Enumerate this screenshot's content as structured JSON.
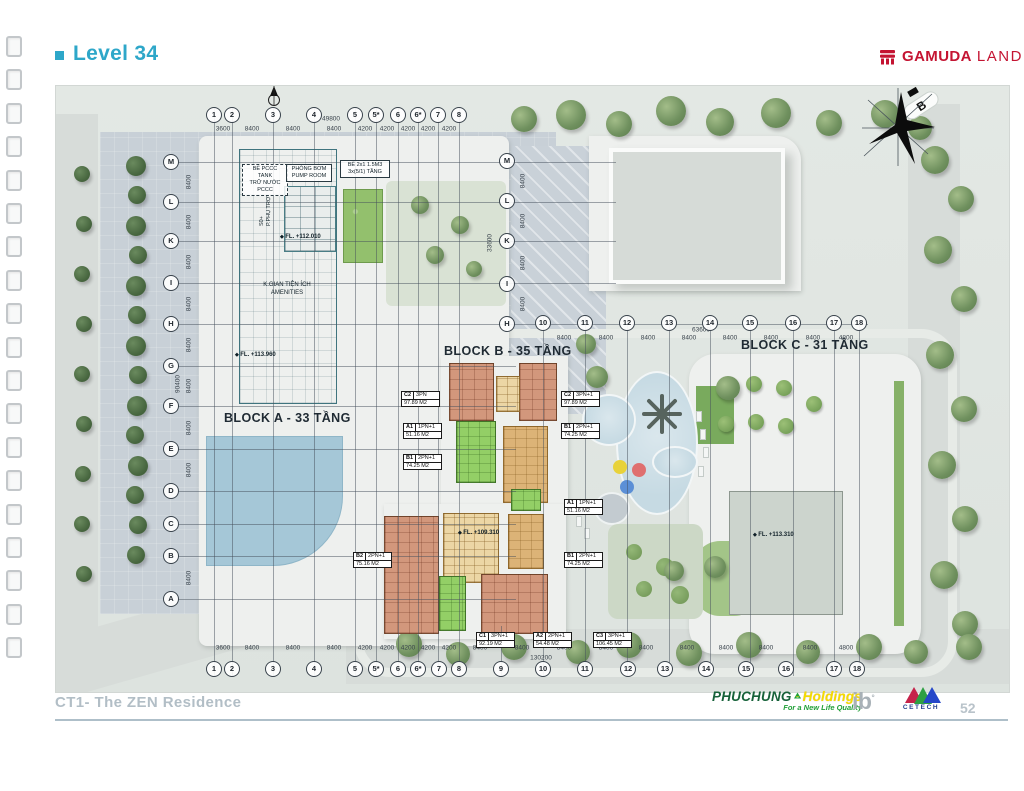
{
  "header": {
    "title": "Level 34",
    "brand": {
      "bold": "GAMUDA",
      "light": "LAND",
      "color": "#c41432"
    }
  },
  "plan": {
    "north_label": "B",
    "blocks": {
      "a": {
        "label": "BLOCK A - 33 TẦNG",
        "tank": "BỂ PCCC TANK\nTRỮ NƯỚC PCCC",
        "pump": "PHÒNG BƠM\nPUMP ROOM",
        "table": "BỂ 2x1 1.5M3\n3x(5/1) TẦNG",
        "aux": "S0+\nP.PHỤ TRỢ",
        "fl1": "FL. +112.010",
        "fl2": "FL. +113.960",
        "amenities": "K.GIAN TIỆN ÍCH\nAMENITIES"
      },
      "b": {
        "label": "BLOCK B - 35 TẦNG",
        "fl": "FL. +109.310"
      },
      "c": {
        "label": "BLOCK C - 31 TẦNG",
        "fl": "FL. +113.310"
      }
    },
    "grid": {
      "top": [
        {
          "label": "1",
          "x": 158
        },
        {
          "label": "2",
          "x": 176
        },
        {
          "label": "3",
          "x": 217
        },
        {
          "label": "4",
          "x": 258
        },
        {
          "label": "5",
          "x": 299
        },
        {
          "label": "5*",
          "x": 320
        },
        {
          "label": "6",
          "x": 342
        },
        {
          "label": "6*",
          "x": 362
        },
        {
          "label": "7",
          "x": 382
        },
        {
          "label": "8",
          "x": 403
        }
      ],
      "mid": [
        {
          "label": "10",
          "x": 487
        },
        {
          "label": "11",
          "x": 529
        },
        {
          "label": "12",
          "x": 571
        },
        {
          "label": "13",
          "x": 613
        },
        {
          "label": "14",
          "x": 654
        },
        {
          "label": "15",
          "x": 694
        },
        {
          "label": "16",
          "x": 737
        },
        {
          "label": "17",
          "x": 778
        },
        {
          "label": "18",
          "x": 803
        }
      ],
      "bottom": [
        {
          "label": "1",
          "x": 158
        },
        {
          "label": "2",
          "x": 176
        },
        {
          "label": "3",
          "x": 217
        },
        {
          "label": "4",
          "x": 258
        },
        {
          "label": "5",
          "x": 299
        },
        {
          "label": "5*",
          "x": 320
        },
        {
          "label": "6",
          "x": 342
        },
        {
          "label": "6*",
          "x": 362
        },
        {
          "label": "7",
          "x": 383
        },
        {
          "label": "8",
          "x": 403
        },
        {
          "label": "9",
          "x": 445
        },
        {
          "label": "10",
          "x": 487
        },
        {
          "label": "11",
          "x": 529
        },
        {
          "label": "12",
          "x": 572
        },
        {
          "label": "13",
          "x": 609
        },
        {
          "label": "14",
          "x": 650
        },
        {
          "label": "15",
          "x": 690
        },
        {
          "label": "16",
          "x": 730
        },
        {
          "label": "17",
          "x": 778
        },
        {
          "label": "18",
          "x": 801
        }
      ],
      "left_rows": [
        {
          "label": "M",
          "y": 76
        },
        {
          "label": "L",
          "y": 116
        },
        {
          "label": "K",
          "y": 155
        },
        {
          "label": "I",
          "y": 197
        },
        {
          "label": "H",
          "y": 238
        },
        {
          "label": "G",
          "y": 280
        },
        {
          "label": "F",
          "y": 320
        },
        {
          "label": "E",
          "y": 363
        },
        {
          "label": "D",
          "y": 405
        },
        {
          "label": "C",
          "y": 438
        },
        {
          "label": "B",
          "y": 470
        },
        {
          "label": "A",
          "y": 513
        }
      ],
      "mid_rows": [
        {
          "label": "M",
          "y": 75
        },
        {
          "label": "L",
          "y": 115
        },
        {
          "label": "K",
          "y": 155
        },
        {
          "label": "I",
          "y": 198
        },
        {
          "label": "H",
          "y": 238
        }
      ]
    },
    "dims": {
      "top": [
        {
          "t": "3600",
          "x": 167
        },
        {
          "t": "8400",
          "x": 196
        },
        {
          "t": "8400",
          "x": 237
        },
        {
          "t": "8400",
          "x": 278
        },
        {
          "t": "4200",
          "x": 309
        },
        {
          "t": "4200",
          "x": 331
        },
        {
          "t": "4200",
          "x": 352
        },
        {
          "t": "4200",
          "x": 372
        },
        {
          "t": "4200",
          "x": 393
        }
      ],
      "top_overall": {
        "t": "49800",
        "x": 275,
        "y": 33
      },
      "mid": [
        {
          "t": "8400",
          "x": 508
        },
        {
          "t": "8400",
          "x": 550
        },
        {
          "t": "8400",
          "x": 592
        },
        {
          "t": "8400",
          "x": 633
        },
        {
          "t": "8400",
          "x": 674
        },
        {
          "t": "8400",
          "x": 715
        },
        {
          "t": "8400",
          "x": 757
        },
        {
          "t": "4800",
          "x": 790
        }
      ],
      "mid_overall": {
        "t": "63600",
        "x": 645,
        "y": 244
      },
      "bottom": [
        {
          "t": "3600",
          "x": 167
        },
        {
          "t": "8400",
          "x": 196
        },
        {
          "t": "8400",
          "x": 237
        },
        {
          "t": "8400",
          "x": 278
        },
        {
          "t": "4200",
          "x": 309
        },
        {
          "t": "4200",
          "x": 331
        },
        {
          "t": "4200",
          "x": 352
        },
        {
          "t": "4200",
          "x": 372
        },
        {
          "t": "4200",
          "x": 393
        },
        {
          "t": "8400",
          "x": 424
        },
        {
          "t": "8400",
          "x": 466
        },
        {
          "t": "8400",
          "x": 508
        },
        {
          "t": "8400",
          "x": 550
        },
        {
          "t": "8400",
          "x": 590
        },
        {
          "t": "8400",
          "x": 631
        },
        {
          "t": "8400",
          "x": 670
        },
        {
          "t": "8400",
          "x": 710
        },
        {
          "t": "8400",
          "x": 754
        },
        {
          "t": "4800",
          "x": 790
        }
      ],
      "bottom_overall": {
        "t": "130200",
        "x": 485,
        "y": 572
      },
      "left": [
        {
          "t": "8400",
          "y": 96
        },
        {
          "t": "8400",
          "y": 136
        },
        {
          "t": "8400",
          "y": 176
        },
        {
          "t": "8400",
          "y": 218
        },
        {
          "t": "8400",
          "y": 259
        },
        {
          "t": "8400",
          "y": 300
        },
        {
          "t": "8400",
          "y": 342
        },
        {
          "t": "8400",
          "y": 384
        },
        {
          "t": "8400",
          "y": 492
        }
      ],
      "left_overall": {
        "t": "90400",
        "x": 122,
        "y": 298
      },
      "mid_col": [
        {
          "t": "8400",
          "y": 95
        },
        {
          "t": "8400",
          "y": 135
        },
        {
          "t": "8400",
          "y": 177
        },
        {
          "t": "8400",
          "y": 218
        }
      ],
      "mid_col_overall": {
        "t": "33600",
        "x": 434,
        "y": 157
      }
    },
    "unit_callouts": [
      {
        "code": "C2",
        "type": "3PN",
        "area": "97.89 M2",
        "x": 345,
        "y": 305
      },
      {
        "code": "C2",
        "type": "3PN+1",
        "area": "97.89 M2",
        "x": 505,
        "y": 305
      },
      {
        "code": "A1",
        "type": "1PN+1",
        "area": "51.16 M2",
        "x": 347,
        "y": 337
      },
      {
        "code": "B1",
        "type": "2PN+1",
        "area": "74.25 M2",
        "x": 505,
        "y": 337
      },
      {
        "code": "B1",
        "type": "2PN+1",
        "area": "74.25 M2",
        "x": 347,
        "y": 368
      },
      {
        "code": "B2",
        "type": "2PN+1",
        "area": "75.16 M2",
        "x": 297,
        "y": 466
      },
      {
        "code": "A1",
        "type": "1PN+1",
        "area": "51.16 M2",
        "x": 508,
        "y": 413
      },
      {
        "code": "B1",
        "type": "2PN+1",
        "area": "74.25 M2",
        "x": 508,
        "y": 466
      },
      {
        "code": "C1",
        "type": "3PN+1",
        "area": "92.19 M2",
        "x": 420,
        "y": 546
      },
      {
        "code": "A2",
        "type": "2PN+1",
        "area": "54.48 M2",
        "x": 477,
        "y": 546
      },
      {
        "code": "C3",
        "type": "3PN+1",
        "area": "106.45 M2",
        "x": 537,
        "y": 546
      }
    ]
  },
  "footer": {
    "project": "CT1- The ZEN Residence",
    "page_number": "52",
    "phuchung": {
      "name": "PHUCHUNG",
      "holdings": "Holdings",
      "tagline": "For a New Life Quality"
    },
    "ib_label": "ib",
    "cetech_label": "CETECH"
  }
}
